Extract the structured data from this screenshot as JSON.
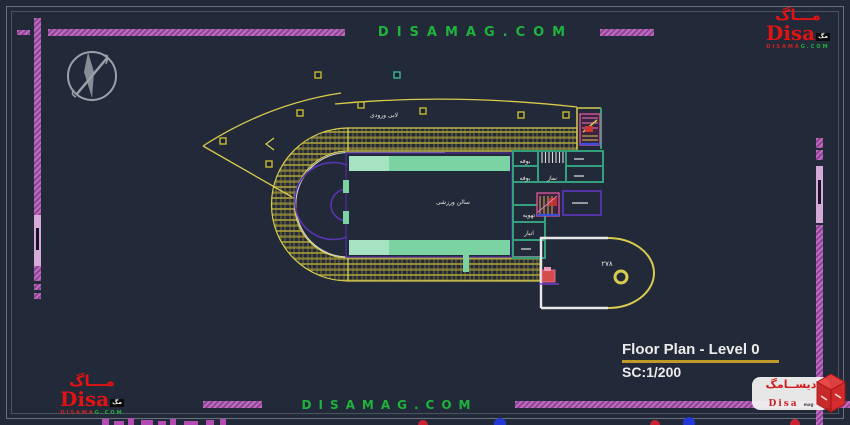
{
  "brand": {
    "watermark_text": "DISAMAG.COM",
    "logo": {
      "arabic": "مـــاگ",
      "name": "Disa",
      "suffix": "مگ",
      "domain_a": "DISAMA",
      "domain_b": "G.COM"
    },
    "corner_badge": {
      "arabic": "دیســامگ",
      "name": "Disa",
      "suffix": "mag"
    }
  },
  "title_block": {
    "title": "Floor Plan - Level 0",
    "scale": "SC:1/200"
  },
  "plan": {
    "labels": {
      "lobby": "لابی ورودی",
      "hall": "سالن ورزشی",
      "buffet1": "بوفه",
      "buffet2": "بوفه",
      "prayer": "نماز",
      "hvac": "تهویه",
      "storage": "انبار",
      "area_number": "۲۷۸"
    }
  },
  "colors": {
    "background": "#222938",
    "cad_yellow": "#d8cb4e",
    "cad_magenta": "#b458b4",
    "cad_purple": "#4c2b96",
    "cad_green": "#7bd3a4",
    "cad_teal": "#35a07e",
    "brand_green": "#1fb33e",
    "brand_red": "#e01414",
    "white": "#e8e8e6"
  }
}
